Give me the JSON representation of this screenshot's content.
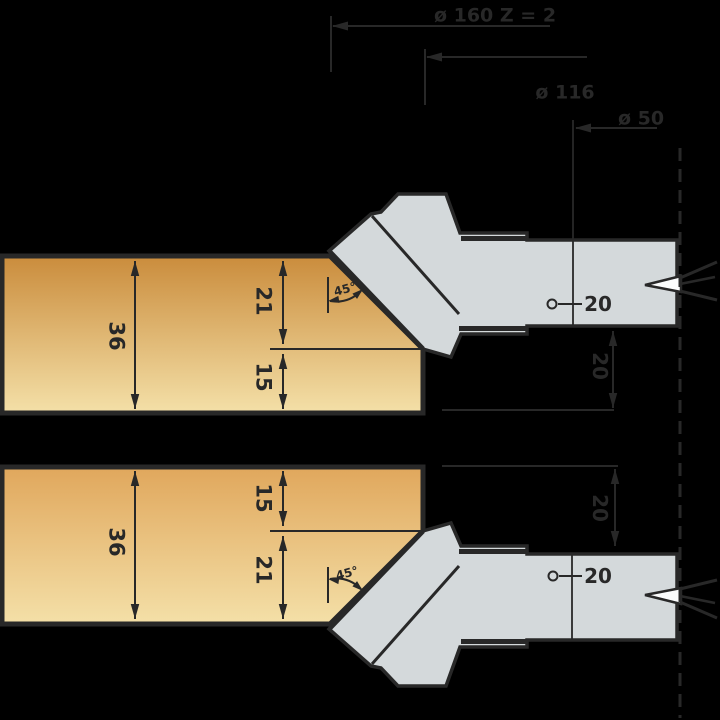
{
  "page": {
    "background": "#000000",
    "width": 720,
    "height": 720
  },
  "drawing": {
    "ink": "#282828",
    "tool_fill": "#d4d9db",
    "wedge_fill": "#fbfcfc",
    "wood_top_gradient": [
      "#ca8c3c",
      "#f4e0a8"
    ],
    "wood_bottom_gradient": [
      "#e0a75c",
      "#f4e0a8"
    ],
    "values": {
      "cutting_diameter": "ø 160",
      "teeth": "Z = 2",
      "body_diameter": "ø 116",
      "hub_diameter": "ø 50",
      "bore": "20",
      "workpiece_thickness": "36",
      "chamfer_height": "21",
      "remaining_height": "15",
      "chamfer_angle": "45°",
      "axial_height": "20"
    },
    "shapes": [
      {
        "type": "poly",
        "name": "top-workpiece",
        "points": "2,256 330,256 423,349 423,413 2,413",
        "fill": "wood_top",
        "w": 5
      },
      {
        "type": "line",
        "name": "top-workpiece-step-line",
        "x1": 270,
        "y1": 349,
        "x2": 421,
        "y2": 349,
        "w": 2
      },
      {
        "type": "poly",
        "name": "bottom-workpiece",
        "points": "2,467 423,467 423,531 330,624 2,624",
        "fill": "wood_bottom",
        "w": 5
      },
      {
        "type": "line",
        "name": "bottom-workpiece-step-line",
        "x1": 270,
        "y1": 531,
        "x2": 421,
        "y2": 531,
        "w": 2
      },
      {
        "type": "dim",
        "name": "dim-36-top",
        "x1": 135,
        "y1": 261,
        "x2": 135,
        "y2": 409,
        "w": 2
      },
      {
        "type": "text",
        "name": "label-36-top",
        "text": "36",
        "x": 117,
        "y": 336,
        "size": 21,
        "rot": 90
      },
      {
        "type": "dim",
        "name": "dim-21-top",
        "x1": 283,
        "y1": 261,
        "x2": 283,
        "y2": 344,
        "w": 2
      },
      {
        "type": "text",
        "name": "label-21-top",
        "text": "21",
        "x": 264,
        "y": 301,
        "size": 21,
        "rot": 90
      },
      {
        "type": "dim",
        "name": "dim-15-top",
        "x1": 283,
        "y1": 354,
        "x2": 283,
        "y2": 409,
        "w": 2
      },
      {
        "type": "text",
        "name": "label-15-top",
        "text": "15",
        "x": 264,
        "y": 377,
        "size": 21,
        "rot": 90
      },
      {
        "type": "dim",
        "name": "dim-36-bottom",
        "x1": 135,
        "y1": 471,
        "x2": 135,
        "y2": 619,
        "w": 2
      },
      {
        "type": "text",
        "name": "label-36-bottom",
        "text": "36",
        "x": 117,
        "y": 542,
        "size": 21,
        "rot": 90
      },
      {
        "type": "dim",
        "name": "dim-15-bottom",
        "x1": 283,
        "y1": 471,
        "x2": 283,
        "y2": 526,
        "w": 2
      },
      {
        "type": "text",
        "name": "label-15-bottom",
        "text": "15",
        "x": 264,
        "y": 498,
        "size": 21,
        "rot": 90
      },
      {
        "type": "dim",
        "name": "dim-21-bottom",
        "x1": 283,
        "y1": 536,
        "x2": 283,
        "y2": 619,
        "w": 2
      },
      {
        "type": "text",
        "name": "label-21-bottom",
        "text": "21",
        "x": 264,
        "y": 570,
        "size": 21,
        "rot": 90
      },
      {
        "type": "line",
        "name": "angle-ref-line-top",
        "x1": 328,
        "y1": 277,
        "x2": 328,
        "y2": 313,
        "w": 2
      },
      {
        "type": "path",
        "name": "angle-arc-top",
        "d": "M330,301 Q348,304 361,291",
        "w": 2
      },
      {
        "type": "arrow",
        "name": "angle-arrow-top-left",
        "tip": [
          328,
          301
        ],
        "dir": [
          -1,
          0.15
        ],
        "len": 11,
        "wid": 7
      },
      {
        "type": "arrow",
        "name": "angle-arrow-top-right",
        "tip": [
          363,
          289
        ],
        "dir": [
          0.75,
          -0.66
        ],
        "len": 11,
        "wid": 7
      },
      {
        "type": "text",
        "name": "label-45-top",
        "text": "45°",
        "x": 345,
        "y": 289,
        "size": 12,
        "rot": -15
      },
      {
        "type": "line",
        "name": "angle-ref-line-bottom",
        "x1": 328,
        "y1": 567,
        "x2": 328,
        "y2": 603,
        "w": 2
      },
      {
        "type": "path",
        "name": "angle-arc-bottom",
        "d": "M330,579 Q348,576 361,589",
        "w": 2
      },
      {
        "type": "arrow",
        "name": "angle-arrow-bottom-left",
        "tip": [
          328,
          579
        ],
        "dir": [
          -1,
          -0.15
        ],
        "len": 11,
        "wid": 7
      },
      {
        "type": "arrow",
        "name": "angle-arrow-bottom-right",
        "tip": [
          363,
          591
        ],
        "dir": [
          0.75,
          0.66
        ],
        "len": 11,
        "wid": 7
      },
      {
        "type": "text",
        "name": "label-45-bottom",
        "text": "45°",
        "x": 347,
        "y": 573,
        "size": 12,
        "rot": -15
      },
      {
        "type": "path",
        "name": "cutterhead-top-body",
        "d": "M329,251 L371,214 L381,212 L398,194 L446,194 L460,233 L527,233 L527,240 L677,240 L677,326 L527,326 L527,334 L461,334 L451,357 L423,349 Z",
        "fill": "tool",
        "w": 3.5
      },
      {
        "type": "line",
        "name": "cutterhead-top-knife-edge",
        "x1": 330,
        "y1": 252,
        "x2": 423,
        "y2": 349,
        "w": 5
      },
      {
        "type": "line",
        "name": "cutterhead-top-knife-back-edge",
        "x1": 372,
        "y1": 216,
        "x2": 459,
        "y2": 314,
        "w": 3
      },
      {
        "type": "rect",
        "name": "cutterhead-top-slot-upper",
        "x": 461,
        "y": 236,
        "wd": 66,
        "ht": 5
      },
      {
        "type": "rect",
        "name": "cutterhead-top-slot-lower",
        "x": 459,
        "y": 326,
        "wd": 68,
        "ht": 5
      },
      {
        "type": "line",
        "name": "hub-edge-line-top",
        "x1": 573,
        "y1": 120,
        "x2": 573,
        "y2": 326,
        "w": 1.8
      },
      {
        "type": "path",
        "name": "knife-mark-top-wedge",
        "d": "M645,285 L681,276 L681,292 Z",
        "fill": "wedge",
        "w": 2.5
      },
      {
        "type": "line",
        "name": "knife-mark-top-ray-upper",
        "x1": 680,
        "y1": 278,
        "x2": 717,
        "y2": 262,
        "w": 3
      },
      {
        "type": "line",
        "name": "knife-mark-top-ray-mid",
        "x1": 680,
        "y1": 284,
        "x2": 715,
        "y2": 277,
        "w": 2.5
      },
      {
        "type": "line",
        "name": "knife-mark-top-ray-lower",
        "x1": 680,
        "y1": 291,
        "x2": 717,
        "y2": 300,
        "w": 3
      },
      {
        "type": "circle",
        "name": "bore-mark-top",
        "cx": 552,
        "cy": 304,
        "r": 4.5,
        "w": 2
      },
      {
        "type": "line",
        "name": "bore-leader-top",
        "x1": 558,
        "y1": 304,
        "x2": 582,
        "y2": 304,
        "w": 2
      },
      {
        "type": "text",
        "name": "label-bore-top",
        "text": "20",
        "x": 598,
        "y": 304,
        "size": 20
      },
      {
        "type": "line",
        "name": "ref-line-top",
        "x1": 442,
        "y1": 410,
        "x2": 614,
        "y2": 410,
        "w": 2
      },
      {
        "type": "dim",
        "name": "dim-20-top",
        "x1": 613,
        "y1": 331,
        "x2": 613,
        "y2": 408,
        "w": 2
      },
      {
        "type": "text",
        "name": "label-20-top",
        "text": "20",
        "x": 600,
        "y": 366,
        "size": 20,
        "rot": 90
      },
      {
        "type": "path",
        "name": "cutterhead-bottom-body",
        "d": "M329,629 L371,666 L381,668 L398,686 L446,686 L460,647 L527,647 L527,640 L677,640 L677,554 L527,554 L527,546 L461,546 L451,523 L423,531 Z",
        "fill": "tool",
        "w": 3.5
      },
      {
        "type": "line",
        "name": "cutterhead-bottom-knife-edge",
        "x1": 330,
        "y1": 628,
        "x2": 423,
        "y2": 531,
        "w": 5
      },
      {
        "type": "line",
        "name": "cutterhead-bottom-knife-back-edge",
        "x1": 372,
        "y1": 664,
        "x2": 459,
        "y2": 566,
        "w": 3
      },
      {
        "type": "rect",
        "name": "cutterhead-bottom-slot-upper",
        "x": 459,
        "y": 549,
        "wd": 68,
        "ht": 5
      },
      {
        "type": "rect",
        "name": "cutterhead-bottom-slot-lower",
        "x": 461,
        "y": 639,
        "wd": 66,
        "ht": 5
      },
      {
        "type": "line",
        "name": "hub-edge-line-bottom",
        "x1": 572,
        "y1": 554,
        "x2": 572,
        "y2": 640,
        "w": 1.8
      },
      {
        "type": "path",
        "name": "knife-mark-bottom-wedge",
        "d": "M645,595 L681,604 L681,588 Z",
        "fill": "wedge",
        "w": 2.5
      },
      {
        "type": "line",
        "name": "knife-mark-bottom-ray-upper",
        "x1": 680,
        "y1": 602,
        "x2": 717,
        "y2": 618,
        "w": 3
      },
      {
        "type": "line",
        "name": "knife-mark-bottom-ray-mid",
        "x1": 680,
        "y1": 596,
        "x2": 715,
        "y2": 603,
        "w": 2.5
      },
      {
        "type": "line",
        "name": "knife-mark-bottom-ray-lower",
        "x1": 680,
        "y1": 589,
        "x2": 717,
        "y2": 580,
        "w": 3
      },
      {
        "type": "circle",
        "name": "bore-mark-bottom",
        "cx": 553,
        "cy": 576,
        "r": 4.5,
        "w": 2
      },
      {
        "type": "line",
        "name": "bore-leader-bottom",
        "x1": 559,
        "y1": 576,
        "x2": 582,
        "y2": 576,
        "w": 2
      },
      {
        "type": "text",
        "name": "label-bore-bottom",
        "text": "20",
        "x": 598,
        "y": 576,
        "size": 20
      },
      {
        "type": "line",
        "name": "ref-line-bottom",
        "x1": 442,
        "y1": 466,
        "x2": 618,
        "y2": 466,
        "w": 2
      },
      {
        "type": "dim",
        "name": "dim-20-bottom",
        "x1": 615,
        "y1": 469,
        "x2": 615,
        "y2": 546,
        "w": 2
      },
      {
        "type": "text",
        "name": "label-20-bottom",
        "text": "20",
        "x": 600,
        "y": 508,
        "size": 20,
        "rot": 90
      },
      {
        "type": "line",
        "name": "ext-line-160",
        "x1": 331,
        "y1": 16,
        "x2": 331,
        "y2": 72,
        "w": 2
      },
      {
        "type": "line",
        "name": "dim-line-160",
        "x1": 333,
        "y1": 26,
        "x2": 550,
        "y2": 26,
        "w": 2
      },
      {
        "type": "arrow",
        "name": "arrow-160",
        "tip": [
          332,
          26
        ],
        "dir": [
          -1,
          0
        ],
        "len": 16,
        "wid": 9
      },
      {
        "type": "text",
        "name": "label-160",
        "text": "ø 160   Z = 2",
        "x": 495,
        "y": 15,
        "size": 19
      },
      {
        "type": "line",
        "name": "ext-line-116",
        "x1": 425,
        "y1": 49,
        "x2": 425,
        "y2": 105,
        "w": 2
      },
      {
        "type": "line",
        "name": "dim-line-116",
        "x1": 427,
        "y1": 57,
        "x2": 587,
        "y2": 57,
        "w": 2
      },
      {
        "type": "arrow",
        "name": "arrow-116",
        "tip": [
          426,
          57
        ],
        "dir": [
          -1,
          0
        ],
        "len": 16,
        "wid": 9
      },
      {
        "type": "text",
        "name": "label-116",
        "text": "ø 116",
        "x": 565,
        "y": 92,
        "size": 19
      },
      {
        "type": "line",
        "name": "dim-line-50",
        "x1": 576,
        "y1": 128,
        "x2": 657,
        "y2": 128,
        "w": 2
      },
      {
        "type": "arrow",
        "name": "arrow-50",
        "tip": [
          575,
          128
        ],
        "dir": [
          -1,
          0
        ],
        "len": 16,
        "wid": 9
      },
      {
        "type": "text",
        "name": "label-50",
        "text": "ø 50",
        "x": 641,
        "y": 118,
        "size": 19
      },
      {
        "type": "dash",
        "name": "axis-centerline",
        "x1": 680,
        "y1": 148,
        "x2": 680,
        "y2": 718,
        "w": 3,
        "dash": "13 8"
      }
    ]
  }
}
